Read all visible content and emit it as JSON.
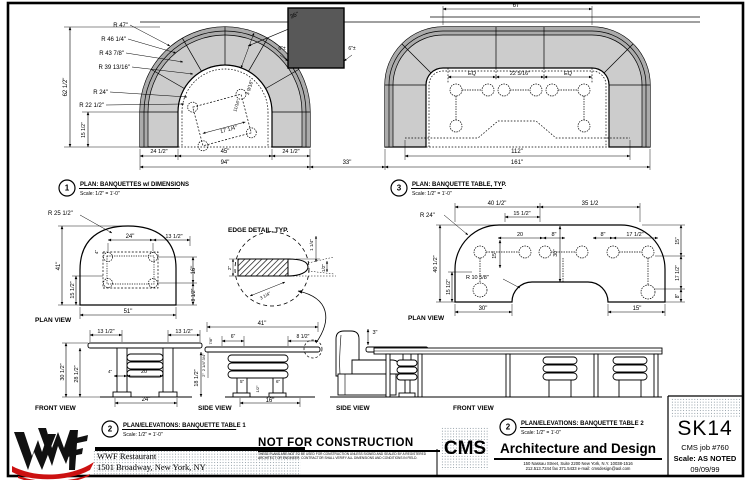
{
  "title_block": {
    "sheet_number": "SK14",
    "job": "CMS job #760",
    "scale": "Scale: AS NOTED",
    "date": "09/09/99",
    "firm_initials": "CMS",
    "firm_name": "Architecture and Design",
    "firm_address_line1": "150 Nassau Street, Suite 2200 New York, N.Y. 10038-1516",
    "firm_address_line2": "212.513.7244   fax 371.5433   e-mail: cmsdesign@aol.com",
    "client_line1": "WWF Restaurant",
    "client_line2": "1501 Broadway, New York, NY",
    "logo_brand": "WWF"
  },
  "stamp": {
    "text": "NOT FOR CONSTRUCTION",
    "fine_print_line1": "THESE PLANS ARE NOT TO BE USED FOR CONSTRUCTION UNLESS SIGNED AND SEALED BY A REGISTERED ARCHITECT OR ENGINEER.",
    "fine_print_line2": "CONTRACTOR SHALL VERIFY ALL DIMENSIONS AND CONDITIONS IN FIELD."
  },
  "callouts": {
    "plan_banquettes": {
      "num": "1",
      "title": "PLAN: BANQUETTES w/ DIMENSIONS",
      "scale": "Scale: 1/2\" = 1'-0\"",
      "x": 67,
      "y": 188
    },
    "plan_banquette_table": {
      "num": "3",
      "title": "PLAN: BANQUETTE TABLE, TYP.",
      "scale": "Scale: 1/2\" = 1'-0\"",
      "x": 399,
      "y": 188
    },
    "elev_table1": {
      "num": "2",
      "title": "PLAN/ELEVATIONS: BANQUETTE TABLE 1",
      "scale": "Scale: 1/2\" = 1'-0\"",
      "x": 110,
      "y": 429
    },
    "elev_table2": {
      "num": "2",
      "title": "PLAN/ELEVATIONS: BANQUETTE TABLE 2",
      "scale": "Scale: 1/2\" = 1'-0\"",
      "x": 508,
      "y": 427
    }
  },
  "annotations": [
    {
      "x": 128,
      "y": 27,
      "t": "R 47\"",
      "a": "end"
    },
    {
      "x": 126,
      "y": 41,
      "t": "R 46 1/4\"",
      "a": "end"
    },
    {
      "x": 124,
      "y": 55,
      "t": "R 43 7/8\"",
      "a": "end"
    },
    {
      "x": 130,
      "y": 69,
      "t": "R 39 13/16\"",
      "a": "end"
    },
    {
      "x": 108,
      "y": 94,
      "t": "R 24\"",
      "a": "end"
    },
    {
      "x": 104,
      "y": 107,
      "t": "R 22 1/2\"",
      "a": "end"
    },
    {
      "x": 67,
      "y": 87,
      "t": "62 1/2\"",
      "r": -90
    },
    {
      "x": 85,
      "y": 130,
      "t": "15 1/2\"",
      "r": -90,
      "s": 5
    },
    {
      "x": 159,
      "y": 153,
      "t": "24 1/2\"",
      "s": 5.5
    },
    {
      "x": 225,
      "y": 153,
      "t": "45\""
    },
    {
      "x": 291,
      "y": 153,
      "t": "24 1/2\"",
      "s": 5.5
    },
    {
      "x": 225,
      "y": 164,
      "t": "94\""
    },
    {
      "x": 347,
      "y": 164,
      "t": "33\""
    },
    {
      "x": 295,
      "y": 17,
      "t": "36\"",
      "r": -23
    },
    {
      "x": 282,
      "y": 50,
      "t": "6\"±",
      "s": 5
    },
    {
      "x": 352,
      "y": 50,
      "t": "6\"±",
      "s": 5
    },
    {
      "x": 229,
      "y": 131,
      "t": "17 1/4\"",
      "r": -15,
      "s": 5.5
    },
    {
      "x": 251,
      "y": 88,
      "t": "3 9/16\"",
      "r": -72,
      "s": 5
    },
    {
      "x": 238,
      "y": 106,
      "t": "11/16\"",
      "r": -72,
      "s": 4.5
    },
    {
      "x": 517,
      "y": 7,
      "t": "67\""
    },
    {
      "x": 472,
      "y": 75,
      "t": "EQ",
      "s": 5.5
    },
    {
      "x": 520,
      "y": 75,
      "t": "22 5/16\"",
      "s": 5.5
    },
    {
      "x": 568,
      "y": 75,
      "t": "EQ",
      "s": 5.5
    },
    {
      "x": 517,
      "y": 153,
      "t": "112\""
    },
    {
      "x": 517,
      "y": 164,
      "t": "161\""
    },
    {
      "x": 48,
      "y": 215,
      "t": "R 25 1/2\"",
      "a": "start"
    },
    {
      "x": 130,
      "y": 238,
      "t": "24\""
    },
    {
      "x": 174,
      "y": 238,
      "t": "13 1/2\"",
      "s": 5.5
    },
    {
      "x": 60,
      "y": 266,
      "t": "41\"",
      "r": -90
    },
    {
      "x": 74,
      "y": 290,
      "t": "15 1/2\"",
      "r": -90,
      "s": 5.5
    },
    {
      "x": 98,
      "y": 252,
      "t": "4\"",
      "r": -90,
      "s": 4.5
    },
    {
      "x": 195,
      "y": 270,
      "t": "16\"",
      "r": -90
    },
    {
      "x": 195,
      "y": 295,
      "t": "8 1/2\"",
      "r": -90,
      "s": 5
    },
    {
      "x": 128,
      "y": 313,
      "t": "51\""
    },
    {
      "x": 35,
      "y": 322,
      "t": "PLAN VIEW",
      "a": "start",
      "b": 1,
      "s": 6.5,
      "n": "view-label"
    },
    {
      "x": 106,
      "y": 333,
      "t": "13 1/2\"",
      "s": 5.5
    },
    {
      "x": 184,
      "y": 333,
      "t": "13 1/2\"",
      "s": 5.5
    },
    {
      "x": 64,
      "y": 372,
      "t": "30 1/2\"",
      "r": -90,
      "s": 5.5
    },
    {
      "x": 78,
      "y": 374,
      "t": "28 1/2\"",
      "r": -90,
      "s": 5.5
    },
    {
      "x": 110,
      "y": 373,
      "t": "4\"",
      "s": 4.5
    },
    {
      "x": 145,
      "y": 373,
      "t": "20\"",
      "s": 5.5
    },
    {
      "x": 146,
      "y": 401,
      "t": "24\""
    },
    {
      "x": 35,
      "y": 410,
      "t": "FRONT VIEW",
      "a": "start",
      "b": 1,
      "s": 6.5,
      "n": "view-label"
    },
    {
      "x": 262,
      "y": 325,
      "t": "41\""
    },
    {
      "x": 212,
      "y": 341,
      "t": "7/8\"",
      "r": -90,
      "s": 4
    },
    {
      "x": 233,
      "y": 338,
      "t": "6\"",
      "s": 5
    },
    {
      "x": 303,
      "y": 338,
      "t": "8 1/2\"",
      "s": 5
    },
    {
      "x": 205,
      "y": 357,
      "t": "3/4\"",
      "r": -90,
      "s": 4
    },
    {
      "x": 205,
      "y": 366,
      "t": "2 1/4\"",
      "r": -90,
      "s": 4
    },
    {
      "x": 205,
      "y": 375,
      "t": "2\"",
      "r": -90,
      "s": 4
    },
    {
      "x": 198,
      "y": 378,
      "t": "18 1/2\"",
      "r": -90,
      "s": 5.5
    },
    {
      "x": 242,
      "y": 383,
      "t": "5\"",
      "s": 4.5
    },
    {
      "x": 278,
      "y": 383,
      "t": "6\"",
      "s": 4.5
    },
    {
      "x": 259,
      "y": 389,
      "t": "1/2\"",
      "r": -90,
      "s": 4
    },
    {
      "x": 270,
      "y": 402,
      "t": "16\""
    },
    {
      "x": 198,
      "y": 410,
      "t": "SIDE VIEW",
      "a": "start",
      "b": 1,
      "s": 6.5,
      "n": "view-label"
    },
    {
      "x": 375,
      "y": 334,
      "t": "3\"",
      "s": 5.5
    },
    {
      "x": 336,
      "y": 410,
      "t": "SIDE VIEW",
      "a": "start",
      "b": 1,
      "s": 6.5,
      "n": "view-label"
    },
    {
      "x": 453,
      "y": 410,
      "t": "FRONT VIEW",
      "a": "start",
      "b": 1,
      "s": 6.5,
      "n": "view-label"
    },
    {
      "x": 228,
      "y": 232,
      "t": "EDGE DETAIL, TYP.",
      "a": "start",
      "b": 1,
      "s": 6.5,
      "n": "detail-label"
    },
    {
      "x": 231,
      "y": 268,
      "t": "2\"",
      "r": -90,
      "s": 4.5
    },
    {
      "x": 313,
      "y": 245,
      "t": "1 1/4\"",
      "r": -90,
      "s": 4.5
    },
    {
      "x": 325,
      "y": 268,
      "t": "1/2\"",
      "r": -90,
      "s": 4.5
    },
    {
      "x": 266,
      "y": 297,
      "t": "3 1/4\"",
      "r": -28,
      "s": 4.5
    },
    {
      "x": 497,
      "y": 205,
      "t": "40 1/2\""
    },
    {
      "x": 590,
      "y": 205,
      "t": "35 1/2"
    },
    {
      "x": 522,
      "y": 215,
      "t": "15 1/2\"",
      "s": 5.5
    },
    {
      "x": 420,
      "y": 217,
      "t": "R 24\"",
      "a": "start"
    },
    {
      "x": 437,
      "y": 264,
      "t": "40 1/2\"",
      "r": -90,
      "s": 5.5
    },
    {
      "x": 450,
      "y": 287,
      "t": "15 1/2\"",
      "r": -90,
      "s": 5
    },
    {
      "x": 520,
      "y": 236,
      "t": "20",
      "s": 5.5
    },
    {
      "x": 554,
      "y": 236,
      "t": "8\"",
      "s": 5.5
    },
    {
      "x": 603,
      "y": 236,
      "t": "8\"",
      "s": 5.5
    },
    {
      "x": 635,
      "y": 236,
      "t": "17 1/2\"",
      "s": 5.5
    },
    {
      "x": 496,
      "y": 255,
      "t": "15\"",
      "r": -90,
      "s": 5
    },
    {
      "x": 557,
      "y": 253,
      "t": "30\"",
      "r": -90,
      "s": 5
    },
    {
      "x": 466,
      "y": 279,
      "t": "R 10 5/8\"",
      "a": "start",
      "s": 5.5
    },
    {
      "x": 679,
      "y": 241,
      "t": "15\"",
      "r": -90,
      "s": 5
    },
    {
      "x": 679,
      "y": 273,
      "t": "17 1/2\"",
      "r": -90,
      "s": 5
    },
    {
      "x": 679,
      "y": 296,
      "t": "8\"",
      "r": -90,
      "s": 5
    },
    {
      "x": 483,
      "y": 310,
      "t": "30\""
    },
    {
      "x": 637,
      "y": 310,
      "t": "15\""
    },
    {
      "x": 408,
      "y": 320,
      "t": "PLAN VIEW",
      "a": "start",
      "b": 1,
      "s": 6.5,
      "n": "view-label"
    }
  ]
}
